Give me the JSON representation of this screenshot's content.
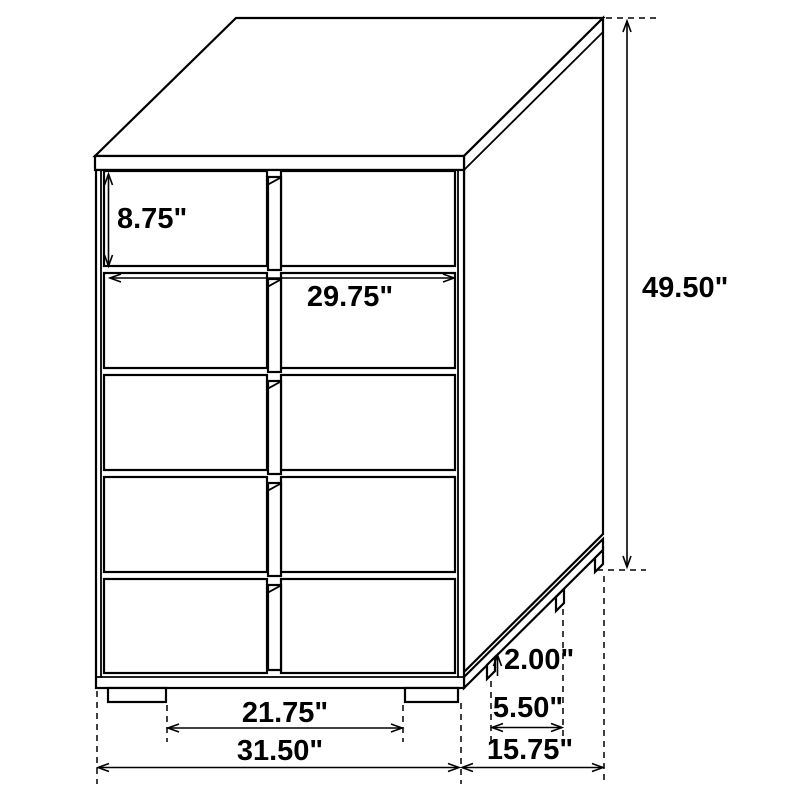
{
  "meta": {
    "title": "5-drawer chest dimensional line drawing",
    "background_color": "#ffffff",
    "line_color": "#000000",
    "unit": "inches"
  },
  "dimensions": {
    "drawer_height": "8.75\"",
    "drawer_width": "29.75\"",
    "overall_height": "49.50\"",
    "foot_height": "2.00\"",
    "side_feet_spacing": "5.50\"",
    "front_feet_spacing": "21.75\"",
    "overall_width": "31.50\"",
    "overall_depth": "15.75\""
  }
}
